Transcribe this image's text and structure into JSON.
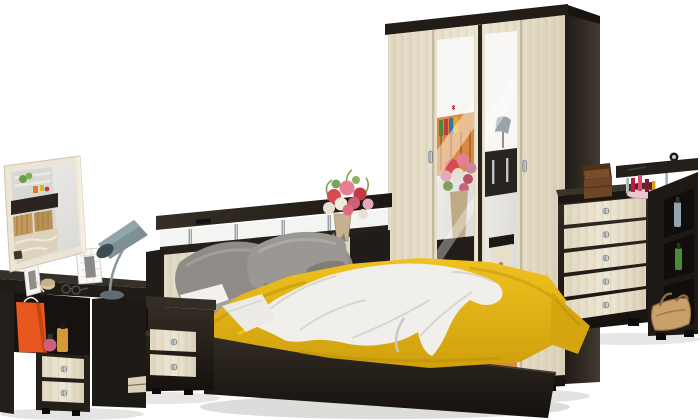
{
  "scene": {
    "description": "Product render of a bedroom furniture set in dark wenge and light oak on a white background",
    "background": "#ffffff",
    "palette": {
      "wenge_dark": "#241f1a",
      "wenge_light": "#3a332b",
      "oak_light": "#e9e2cf",
      "oak_grain": "#d5cbb0",
      "mirror_frame_cream": "#ece5d5",
      "bedspread_yellow": "#e2b016",
      "textile_gray": "#95938f",
      "textile_white": "#efeeea",
      "chrome": "#b9bec2",
      "gift_bag_orange": "#e8571e",
      "vase_tan": "#c7b190",
      "lamp_gray": "#7e9096",
      "handbag_tan": "#c8a06c",
      "flower_red": "#d84a50",
      "flower_pink": "#e87e96"
    },
    "furniture": [
      {
        "id": "wall-mirror",
        "label": "Wall mirror in cream frame with room reflection"
      },
      {
        "id": "desk-lamp",
        "label": "Grey cone desk lamp"
      },
      {
        "id": "dressing-table",
        "label": "Wenge dressing table with two light drawers",
        "decor": [
          "white photo frames",
          "scented candle",
          "glasses",
          "orange gift bag",
          "perfume bottles"
        ]
      },
      {
        "id": "nightstand",
        "label": "Bedside cabinet with two light drawers",
        "decor": [
          "black alarm clock"
        ]
      },
      {
        "id": "double-bed",
        "label": "Double bed with headboard shelf on chrome posts",
        "decor": [
          "flower bouquet in tan vase",
          "grey cat figurine",
          "grey pillows",
          "white sheet",
          "grey blanket",
          "yellow bedspread",
          "white knitted throw",
          "remote"
        ]
      },
      {
        "id": "wardrobe",
        "label": "Four-door wardrobe, two mirrored doors, wenge carcass"
      },
      {
        "id": "chest-of-drawers",
        "label": "Five-drawer chest with raised shelf and side shelving",
        "decor": [
          "open jewellery box",
          "cosmetics tray with lipsticks",
          "small clock",
          "toiletry bottles",
          "green bottle",
          "beige handbag"
        ]
      }
    ]
  }
}
